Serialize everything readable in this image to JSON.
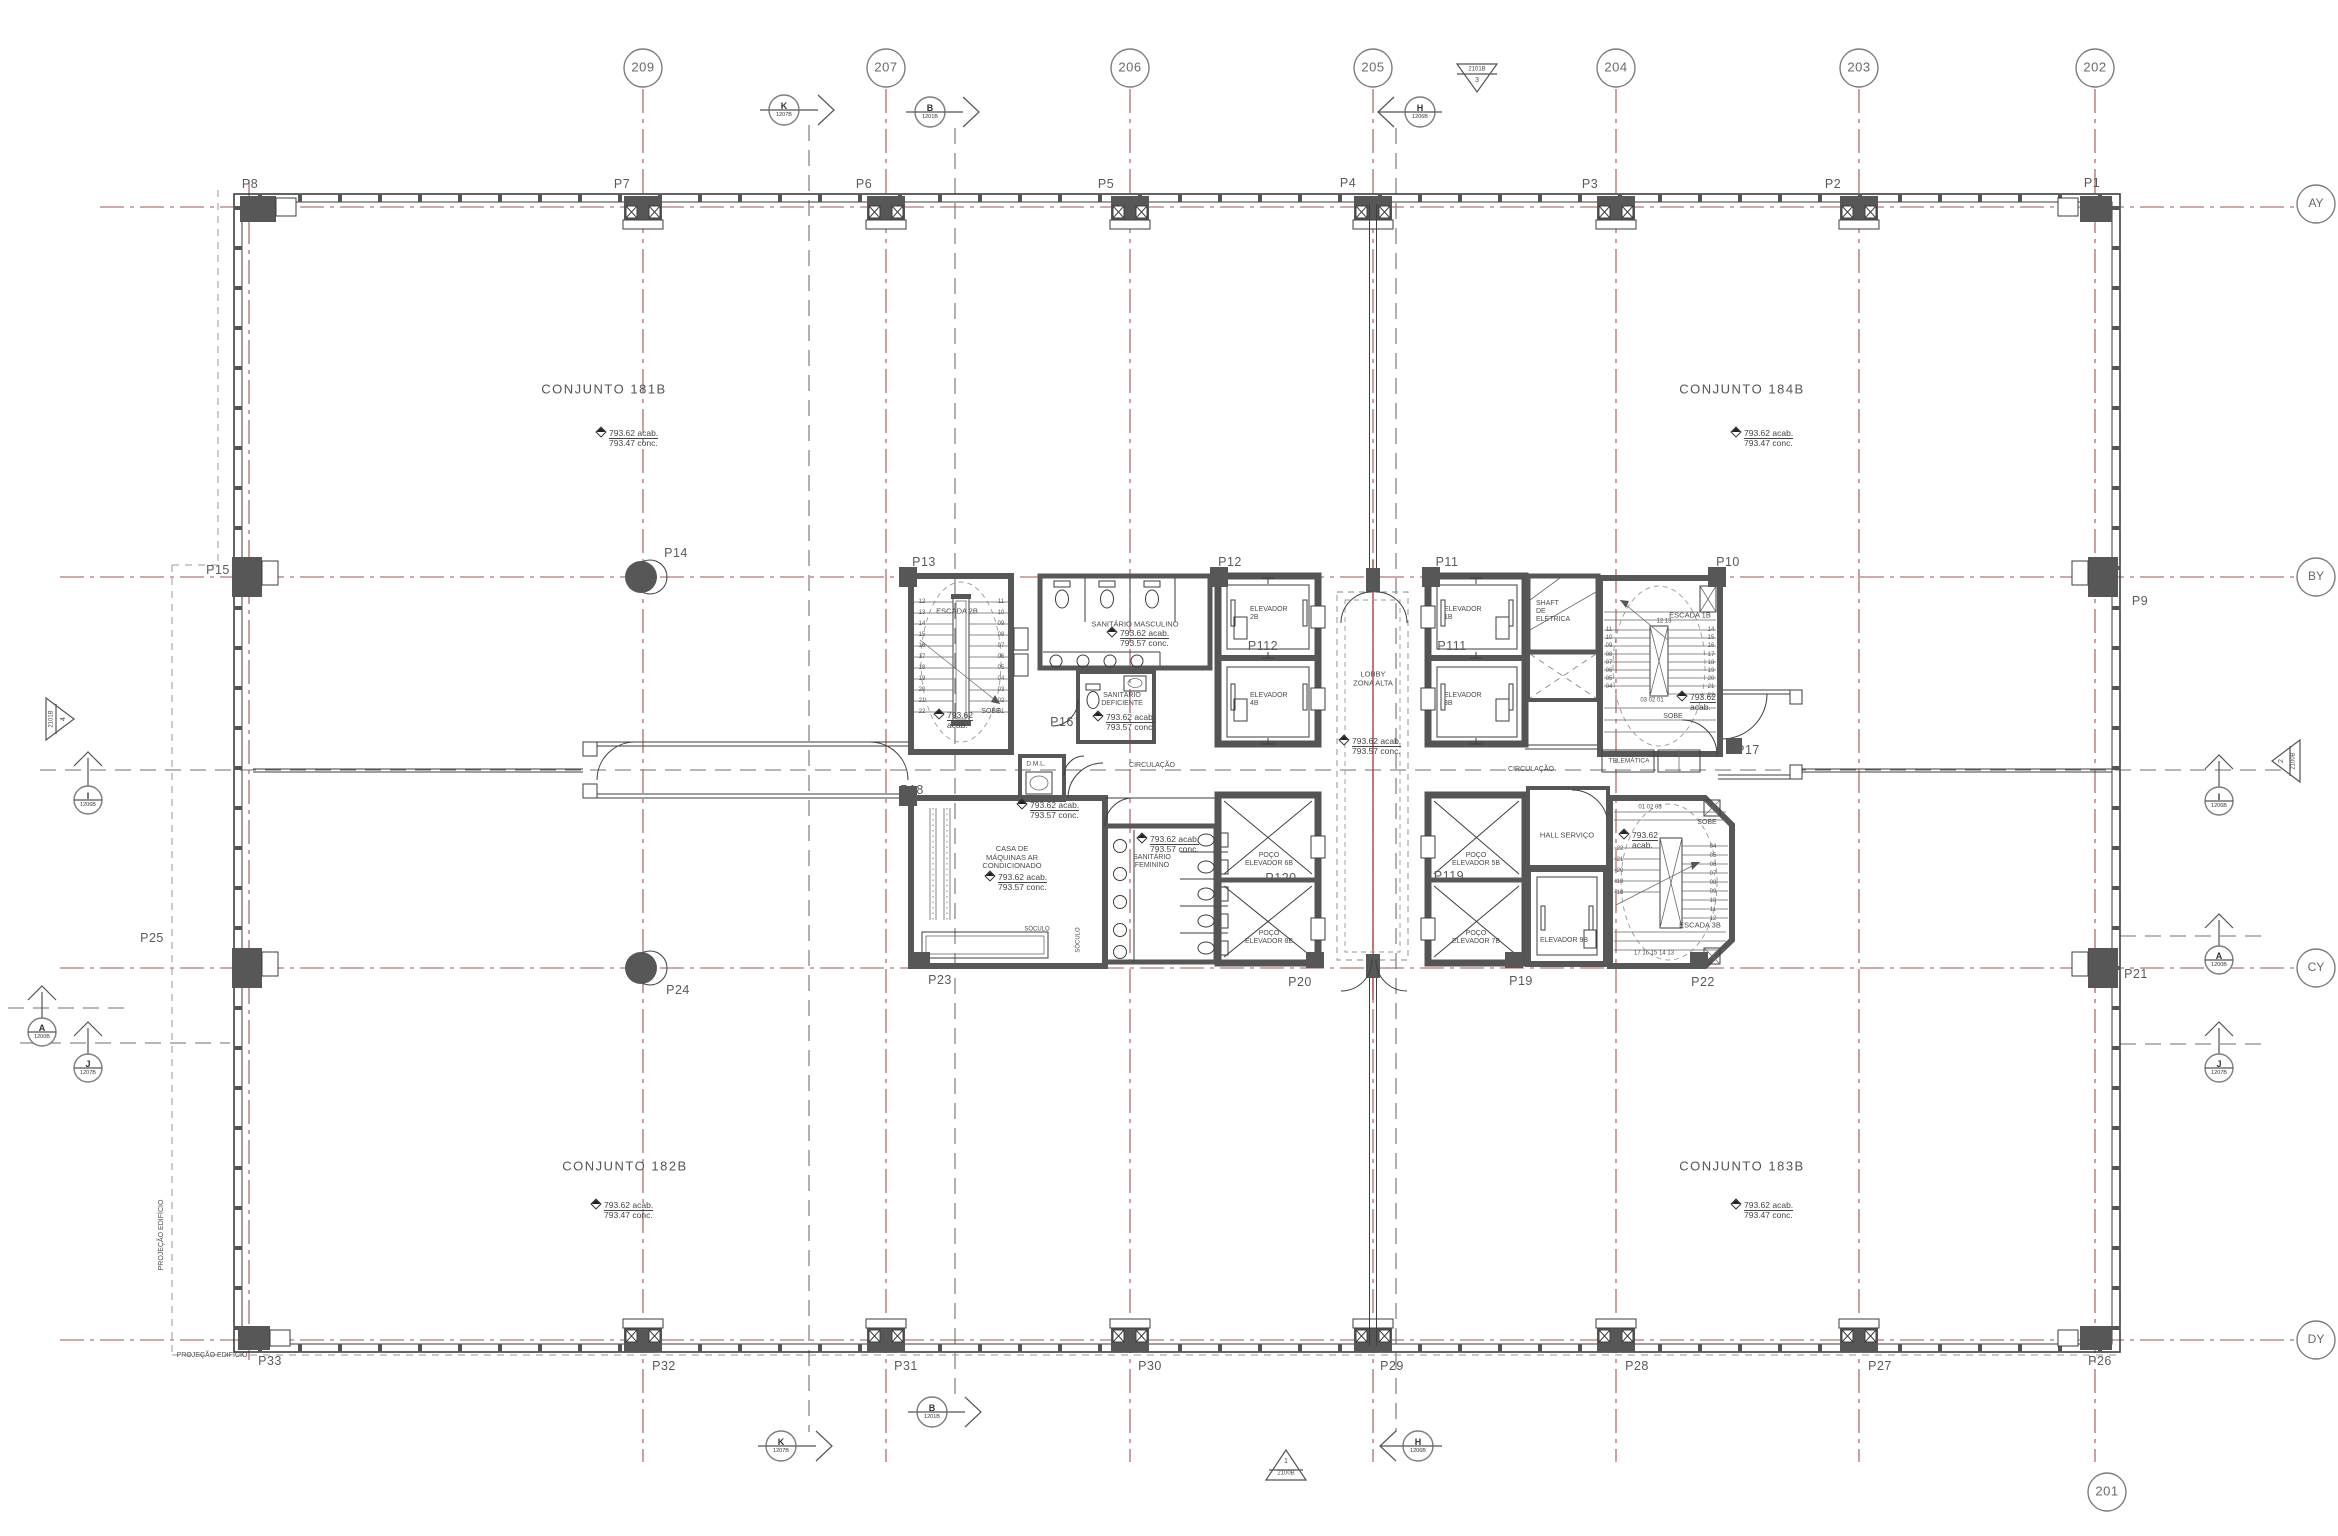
{
  "drawing": {
    "grid": {
      "g209": "209",
      "g207": "207",
      "g206": "206",
      "g205": "205",
      "g204": "204",
      "g203": "203",
      "g202": "202",
      "g201": "201",
      "ay": "AY",
      "by": "BY",
      "cy": "CY",
      "dy": "DY"
    },
    "sections": {
      "k": "K",
      "k_sheet": "1207B",
      "b": "B",
      "b_sheet": "1201B",
      "h": "H",
      "h_sheet": "1206B",
      "i": "I",
      "i_sheet": "1206B",
      "a": "A",
      "a_sheet": "1200B",
      "j": "J",
      "j_sheet": "1207B"
    },
    "triangles": {
      "top_code": "2101B",
      "top_num": "3",
      "left_code": "2101B",
      "left_num": "4",
      "right_code": "2100B",
      "right_num": "2",
      "bottom_code": "2100B",
      "bottom_num": "1"
    },
    "columns": {
      "p1": "P1",
      "p2": "P2",
      "p3": "P3",
      "p4": "P4",
      "p5": "P5",
      "p6": "P6",
      "p7": "P7",
      "p8": "P8",
      "p9": "P9",
      "p10": "P10",
      "p11": "P11",
      "p12": "P12",
      "p13": "P13",
      "p14": "P14",
      "p15": "P15",
      "p16": "P16",
      "p17": "P17",
      "p18": "P18",
      "p19": "P19",
      "p20": "P20",
      "p21": "P21",
      "p22": "P22",
      "p23": "P23",
      "p24": "P24",
      "p25": "P25",
      "p26": "P26",
      "p27": "P27",
      "p28": "P28",
      "p29": "P29",
      "p30": "P30",
      "p31": "P31",
      "p32": "P32",
      "p33": "P33",
      "p111": "P111",
      "p112": "P112",
      "p119": "P119",
      "p120": "P120"
    },
    "units": {
      "c181": "CONJUNTO 181B",
      "c182": "CONJUNTO 182B",
      "c183": "CONJUNTO 183B",
      "c184": "CONJUNTO 184B",
      "level_acab": "793.62 acab.",
      "level_conc": "793.47 conc."
    },
    "core": {
      "escada2b": "ESCADA 2B",
      "escada1b": "ESCADA 1B",
      "escada3b": "ESCADA 3B",
      "sanit_masc": "SANITÁRIO MASCULINO",
      "sanit_def": "SANITÁRIO\nDEFICIENTE",
      "sanit_fem": "SANITÁRIO\nFEMININO",
      "casa_maq": "CASA DE\nMÁQUINAS AR\nCONDICIONADO",
      "shaft": "SHAFT\nDE\nELÉTRICA",
      "telematica": "TELEMÁTICA",
      "hall_servico": "HALL SERVIÇO",
      "dml": "D.M.L.",
      "lobby": "LOBBY\nZONA ALTA",
      "circulacao": "CIRCULAÇÃO",
      "elev1": "ELEVADOR\n1B",
      "elev2": "ELEVADOR\n2B",
      "elev3": "ELEVADOR\n3B",
      "elev4": "ELEVADOR\n4B",
      "elev9": "ELEVADOR 9B",
      "poco5": "POÇO\nELEVADOR 5B",
      "poco6": "POÇO\nELEVADOR 6B",
      "poco7": "POÇO\nELEVADOR 7B",
      "poco8": "POÇO\nELEVADOR 8B",
      "sobe": "SOBE",
      "soculo": "SÓCULO",
      "level_acab": "793.62 acab.",
      "level_conc": "793.57 conc.",
      "level_s1": "793.62",
      "level_s2": "acab."
    },
    "risers": {
      "s2_left": "12\n13\n14\n15\n16\n17\n18\n19\n20\n21\n22",
      "s2_right": "11\n10\n09\n08\n07\n06\n05\n04\n03\n02\n01",
      "s1_left": "11\n10\n09\n08\n07\n06\n05\n04",
      "s1_right": "14\n15\n16\n17\n18\n19\n20\n21\n22",
      "s1_top": "12 13",
      "s1_bottom": "03 02 01",
      "s3_left": "22\n21\n20\n19\n18",
      "s3_right": "04\n05\n06\n07\n08\n09\n10\n11\n12",
      "s3_top": "01 02 03",
      "s3_bottom": "17 16 15 14 13"
    },
    "notes": {
      "projecao": "PROJEÇÃO EDIFÍCIO"
    }
  }
}
